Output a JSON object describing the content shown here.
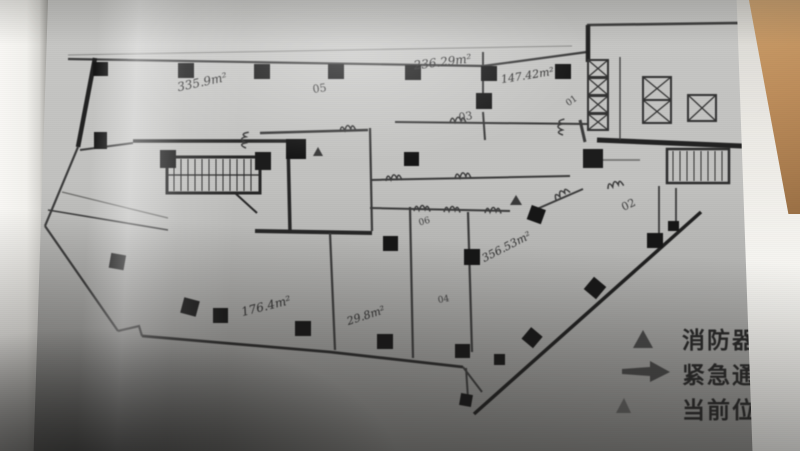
{
  "plan": {
    "area_labels": [
      {
        "text": "335.9m²"
      },
      {
        "text": "236.29m²"
      },
      {
        "text": "147.42m²"
      },
      {
        "text": "356.53m²"
      },
      {
        "text": "176.4m²"
      },
      {
        "text": "29.8m²"
      }
    ],
    "room_numbers": [
      {
        "text": "05"
      },
      {
        "text": "03"
      },
      {
        "text": "01"
      },
      {
        "text": "02"
      },
      {
        "text": "06"
      },
      {
        "text": "04"
      }
    ]
  },
  "legend": {
    "items": [
      {
        "icon": "fire-extinguisher-triangle-icon",
        "label": "消防器"
      },
      {
        "icon": "emergency-arrow-icon",
        "label": "紧急通"
      },
      {
        "icon": "current-location-marker-icon",
        "label": "当前位"
      }
    ]
  },
  "colors": {
    "ink": "#2e2e2e",
    "paper": "#bcbcba",
    "wood": "#b98c5a"
  }
}
